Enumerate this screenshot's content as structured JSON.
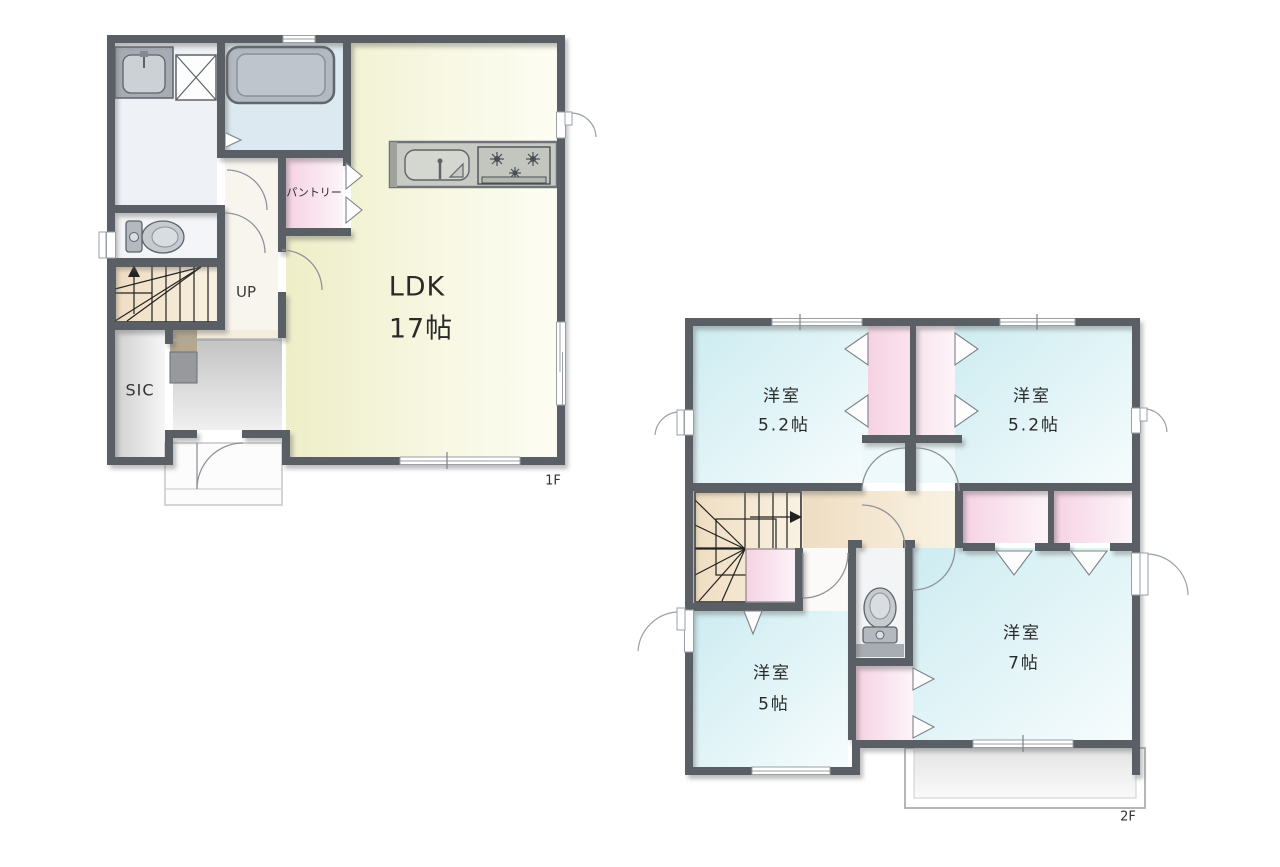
{
  "plan": {
    "type": "floor-plan",
    "floor1": {
      "floor_label": "1F",
      "ldk": {
        "name": "LDK",
        "size": "17帖"
      },
      "pantry": {
        "name": "パントリー"
      },
      "stairs": {
        "direction_label": "UP"
      },
      "sic": {
        "name": "SIC"
      },
      "fixtures": [
        "bathtub",
        "washbasin",
        "washing-machine",
        "toilet",
        "kitchen-sink",
        "stove"
      ]
    },
    "floor2": {
      "floor_label": "2F",
      "bedroom_top_left": {
        "name": "洋室",
        "size": "5.2帖"
      },
      "bedroom_top_right": {
        "name": "洋室",
        "size": "5.2帖"
      },
      "bedroom_bottom_left": {
        "name": "洋室",
        "size": "5帖"
      },
      "bedroom_bottom_right": {
        "name": "洋室",
        "size": "7帖"
      },
      "fixtures": [
        "toilet",
        "balcony",
        "closets"
      ]
    },
    "colors": {
      "wall": "#5a5f66",
      "ldk_floor": "#f1f1cd",
      "bedroom_floor": "#d2edf1",
      "closet_pink": "#f6d6e5",
      "stairs_hall_beige": "#f1e1c7",
      "bathroom_blue": "#dce9f1",
      "entrance_gray": "#cccccc"
    }
  }
}
